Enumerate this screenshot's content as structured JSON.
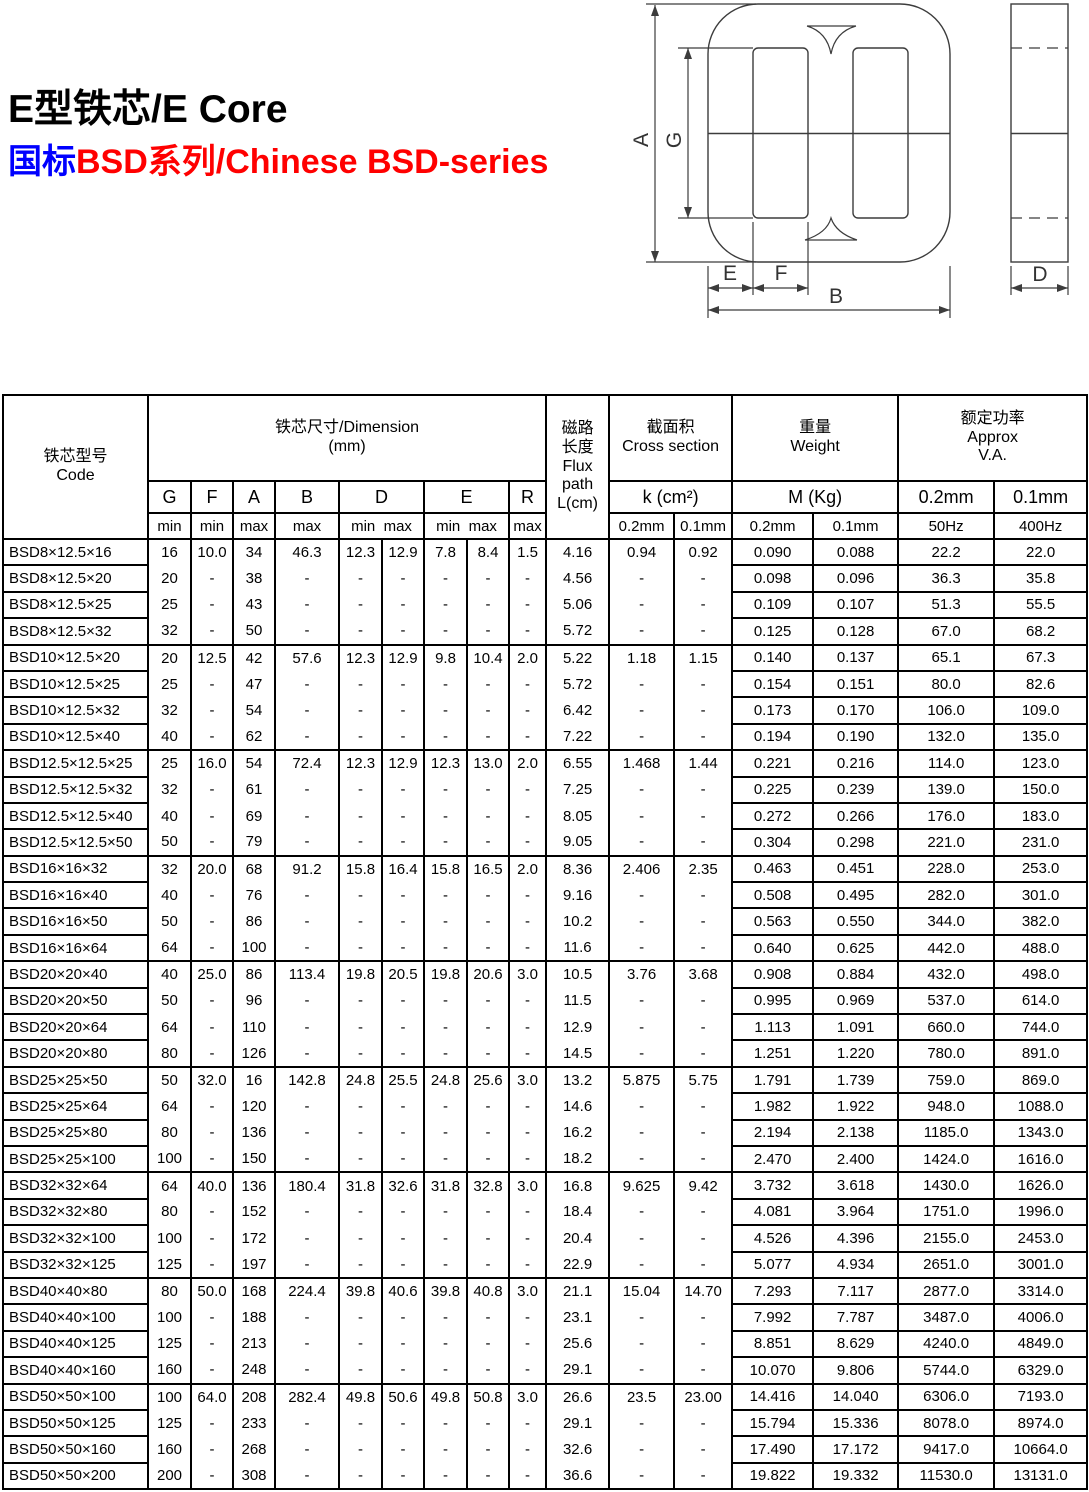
{
  "page": {
    "title": "E型铁芯/E Core",
    "subtitle_blue": "国标",
    "subtitle_red": "BSD系列/Chinese BSD-series",
    "colors": {
      "subtitle_blue": "#0000ff",
      "subtitle_red": "#ff0000",
      "table_border": "#000000"
    }
  },
  "diagram": {
    "description": "E-core front view and side view with dimension arrows",
    "labels": {
      "A": "A",
      "G": "G",
      "E": "E",
      "F": "F",
      "B": "B",
      "D": "D"
    }
  },
  "table": {
    "header": {
      "code": "铁芯型号\nCode",
      "dimension": "铁芯尺寸/Dimension\n(mm)",
      "letters": [
        "G",
        "F",
        "A",
        "B",
        "D",
        "E",
        "R"
      ],
      "limits_single": [
        "min",
        "min",
        "max",
        "max",
        "max"
      ],
      "limits_double": "min  max",
      "flux": "磁路\n长度\nFlux\npath\nL(cm)",
      "cross_section": "截面积\nCross section",
      "k_label": "k (cm²)",
      "k_sub": [
        "0.2mm",
        "0.1mm"
      ],
      "weight": "重量\nWeight",
      "m_label": "M (Kg)",
      "m_sub": [
        "0.2mm",
        "0.1mm"
      ],
      "approx": "额定功率\nApprox\nV.A.",
      "va_mid": [
        "0.2mm",
        "0.1mm"
      ],
      "va_sub": [
        "50Hz",
        "400Hz"
      ]
    },
    "groups": [
      [
        [
          "BSD8×12.5×16",
          "16",
          "10.0",
          "34",
          "46.3",
          "12.3",
          "12.9",
          "7.8",
          "8.4",
          "1.5",
          "4.16",
          "0.94",
          "0.92",
          "0.090",
          "0.088",
          "22.2",
          "22.0"
        ],
        [
          "BSD8×12.5×20",
          "20",
          "-",
          "38",
          "-",
          "-",
          "-",
          "-",
          "-",
          "-",
          "4.56",
          "-",
          "-",
          "0.098",
          "0.096",
          "36.3",
          "35.8"
        ],
        [
          "BSD8×12.5×25",
          "25",
          "-",
          "43",
          "-",
          "-",
          "-",
          "-",
          "-",
          "-",
          "5.06",
          "-",
          "-",
          "0.109",
          "0.107",
          "51.3",
          "55.5"
        ],
        [
          "BSD8×12.5×32",
          "32",
          "-",
          "50",
          "-",
          "-",
          "-",
          "-",
          "-",
          "-",
          "5.72",
          "-",
          "-",
          "0.125",
          "0.128",
          "67.0",
          "68.2"
        ]
      ],
      [
        [
          "BSD10×12.5×20",
          "20",
          "12.5",
          "42",
          "57.6",
          "12.3",
          "12.9",
          "9.8",
          "10.4",
          "2.0",
          "5.22",
          "1.18",
          "1.15",
          "0.140",
          "0.137",
          "65.1",
          "67.3"
        ],
        [
          "BSD10×12.5×25",
          "25",
          "-",
          "47",
          "-",
          "-",
          "-",
          "-",
          "-",
          "-",
          "5.72",
          "-",
          "-",
          "0.154",
          "0.151",
          "80.0",
          "82.6"
        ],
        [
          "BSD10×12.5×32",
          "32",
          "-",
          "54",
          "-",
          "-",
          "-",
          "-",
          "-",
          "-",
          "6.42",
          "-",
          "-",
          "0.173",
          "0.170",
          "106.0",
          "109.0"
        ],
        [
          "BSD10×12.5×40",
          "40",
          "-",
          "62",
          "-",
          "-",
          "-",
          "-",
          "-",
          "-",
          "7.22",
          "-",
          "-",
          "0.194",
          "0.190",
          "132.0",
          "135.0"
        ]
      ],
      [
        [
          "BSD12.5×12.5×25",
          "25",
          "16.0",
          "54",
          "72.4",
          "12.3",
          "12.9",
          "12.3",
          "13.0",
          "2.0",
          "6.55",
          "1.468",
          "1.44",
          "0.221",
          "0.216",
          "114.0",
          "123.0"
        ],
        [
          "BSD12.5×12.5×32",
          "32",
          "-",
          "61",
          "-",
          "-",
          "-",
          "-",
          "-",
          "-",
          "7.25",
          "-",
          "-",
          "0.225",
          "0.239",
          "139.0",
          "150.0"
        ],
        [
          "BSD12.5×12.5×40",
          "40",
          "-",
          "69",
          "-",
          "-",
          "-",
          "-",
          "-",
          "-",
          "8.05",
          "-",
          "-",
          "0.272",
          "0.266",
          "176.0",
          "183.0"
        ],
        [
          "BSD12.5×12.5×50",
          "50",
          "-",
          "79",
          "-",
          "-",
          "-",
          "-",
          "-",
          "-",
          "9.05",
          "-",
          "-",
          "0.304",
          "0.298",
          "221.0",
          "231.0"
        ]
      ],
      [
        [
          "BSD16×16×32",
          "32",
          "20.0",
          "68",
          "91.2",
          "15.8",
          "16.4",
          "15.8",
          "16.5",
          "2.0",
          "8.36",
          "2.406",
          "2.35",
          "0.463",
          "0.451",
          "228.0",
          "253.0"
        ],
        [
          "BSD16×16×40",
          "40",
          "-",
          "76",
          "-",
          "-",
          "-",
          "-",
          "-",
          "-",
          "9.16",
          "-",
          "-",
          "0.508",
          "0.495",
          "282.0",
          "301.0"
        ],
        [
          "BSD16×16×50",
          "50",
          "-",
          "86",
          "-",
          "-",
          "-",
          "-",
          "-",
          "-",
          "10.2",
          "-",
          "-",
          "0.563",
          "0.550",
          "344.0",
          "382.0"
        ],
        [
          "BSD16×16×64",
          "64",
          "-",
          "100",
          "-",
          "-",
          "-",
          "-",
          "-",
          "-",
          "11.6",
          "-",
          "-",
          "0.640",
          "0.625",
          "442.0",
          "488.0"
        ]
      ],
      [
        [
          "BSD20×20×40",
          "40",
          "25.0",
          "86",
          "113.4",
          "19.8",
          "20.5",
          "19.8",
          "20.6",
          "3.0",
          "10.5",
          "3.76",
          "3.68",
          "0.908",
          "0.884",
          "432.0",
          "498.0"
        ],
        [
          "BSD20×20×50",
          "50",
          "-",
          "96",
          "-",
          "-",
          "-",
          "-",
          "-",
          "-",
          "11.5",
          "-",
          "-",
          "0.995",
          "0.969",
          "537.0",
          "614.0"
        ],
        [
          "BSD20×20×64",
          "64",
          "-",
          "110",
          "-",
          "-",
          "-",
          "-",
          "-",
          "-",
          "12.9",
          "-",
          "-",
          "1.113",
          "1.091",
          "660.0",
          "744.0"
        ],
        [
          "BSD20×20×80",
          "80",
          "-",
          "126",
          "-",
          "-",
          "-",
          "-",
          "-",
          "-",
          "14.5",
          "-",
          "-",
          "1.251",
          "1.220",
          "780.0",
          "891.0"
        ]
      ],
      [
        [
          "BSD25×25×50",
          "50",
          "32.0",
          "16",
          "142.8",
          "24.8",
          "25.5",
          "24.8",
          "25.6",
          "3.0",
          "13.2",
          "5.875",
          "5.75",
          "1.791",
          "1.739",
          "759.0",
          "869.0"
        ],
        [
          "BSD25×25×64",
          "64",
          "-",
          "120",
          "-",
          "-",
          "-",
          "-",
          "-",
          "-",
          "14.6",
          "-",
          "-",
          "1.982",
          "1.922",
          "948.0",
          "1088.0"
        ],
        [
          "BSD25×25×80",
          "80",
          "-",
          "136",
          "-",
          "-",
          "-",
          "-",
          "-",
          "-",
          "16.2",
          "-",
          "-",
          "2.194",
          "2.138",
          "1185.0",
          "1343.0"
        ],
        [
          "BSD25×25×100",
          "100",
          "-",
          "150",
          "-",
          "-",
          "-",
          "-",
          "-",
          "-",
          "18.2",
          "-",
          "-",
          "2.470",
          "2.400",
          "1424.0",
          "1616.0"
        ]
      ],
      [
        [
          "BSD32×32×64",
          "64",
          "40.0",
          "136",
          "180.4",
          "31.8",
          "32.6",
          "31.8",
          "32.8",
          "3.0",
          "16.8",
          "9.625",
          "9.42",
          "3.732",
          "3.618",
          "1430.0",
          "1626.0"
        ],
        [
          "BSD32×32×80",
          "80",
          "-",
          "152",
          "-",
          "-",
          "-",
          "-",
          "-",
          "-",
          "18.4",
          "-",
          "-",
          "4.081",
          "3.964",
          "1751.0",
          "1996.0"
        ],
        [
          "BSD32×32×100",
          "100",
          "-",
          "172",
          "-",
          "-",
          "-",
          "-",
          "-",
          "-",
          "20.4",
          "-",
          "-",
          "4.526",
          "4.396",
          "2155.0",
          "2453.0"
        ],
        [
          "BSD32×32×125",
          "125",
          "-",
          "197",
          "-",
          "-",
          "-",
          "-",
          "-",
          "-",
          "22.9",
          "-",
          "-",
          "5.077",
          "4.934",
          "2651.0",
          "3001.0"
        ]
      ],
      [
        [
          "BSD40×40×80",
          "80",
          "50.0",
          "168",
          "224.4",
          "39.8",
          "40.6",
          "39.8",
          "40.8",
          "3.0",
          "21.1",
          "15.04",
          "14.70",
          "7.293",
          "7.117",
          "2877.0",
          "3314.0"
        ],
        [
          "BSD40×40×100",
          "100",
          "-",
          "188",
          "-",
          "-",
          "-",
          "-",
          "-",
          "-",
          "23.1",
          "-",
          "-",
          "7.992",
          "7.787",
          "3487.0",
          "4006.0"
        ],
        [
          "BSD40×40×125",
          "125",
          "-",
          "213",
          "-",
          "-",
          "-",
          "-",
          "-",
          "-",
          "25.6",
          "-",
          "-",
          "8.851",
          "8.629",
          "4240.0",
          "4849.0"
        ],
        [
          "BSD40×40×160",
          "160",
          "-",
          "248",
          "-",
          "-",
          "-",
          "-",
          "-",
          "-",
          "29.1",
          "-",
          "-",
          "10.070",
          "9.806",
          "5744.0",
          "6329.0"
        ]
      ],
      [
        [
          "BSD50×50×100",
          "100",
          "64.0",
          "208",
          "282.4",
          "49.8",
          "50.6",
          "49.8",
          "50.8",
          "3.0",
          "26.6",
          "23.5",
          "23.00",
          "14.416",
          "14.040",
          "6306.0",
          "7193.0"
        ],
        [
          "BSD50×50×125",
          "125",
          "-",
          "233",
          "-",
          "-",
          "-",
          "-",
          "-",
          "-",
          "29.1",
          "-",
          "-",
          "15.794",
          "15.336",
          "8078.0",
          "8974.0"
        ],
        [
          "BSD50×50×160",
          "160",
          "-",
          "268",
          "-",
          "-",
          "-",
          "-",
          "-",
          "-",
          "32.6",
          "-",
          "-",
          "17.490",
          "17.172",
          "9417.0",
          "10664.0"
        ],
        [
          "BSD50×50×200",
          "200",
          "-",
          "308",
          "-",
          "-",
          "-",
          "-",
          "-",
          "-",
          "36.6",
          "-",
          "-",
          "19.822",
          "19.332",
          "11530.0",
          "13131.0"
        ]
      ]
    ]
  }
}
